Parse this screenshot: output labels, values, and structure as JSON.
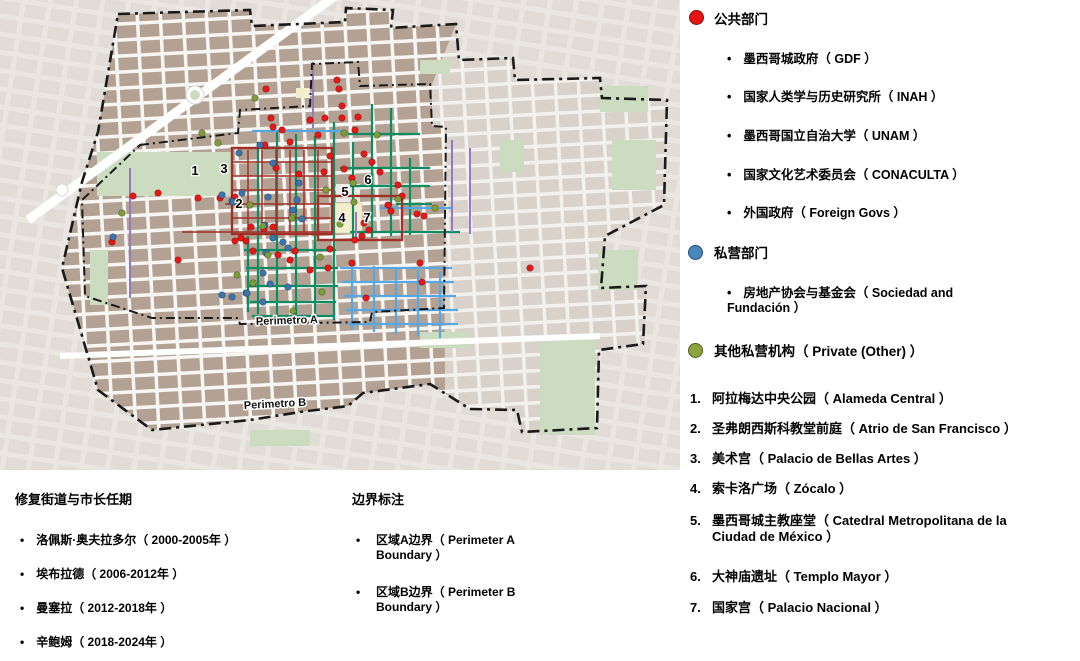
{
  "legend_public": {
    "title": "公共部门",
    "color": "#e81313",
    "items": [
      "墨西哥城政府（ GDF ）",
      "国家人类学与历史研究所（ INAH ）",
      "墨西哥国立自治大学（ UNAM ）",
      "国家文化艺术委员会（ CONACULTA ）",
      "外国政府（ Foreign Govs ）"
    ]
  },
  "legend_private": {
    "title": "私营部门",
    "color": "#4b87bd",
    "items": [
      "房地产协会与基金会（ Sociedad and Fundación ）"
    ]
  },
  "legend_other": {
    "title": "其他私营机构（ Private (Other) ）",
    "color": "#8da33d"
  },
  "landmarks": [
    {
      "num": "1.",
      "text": "阿拉梅达中央公园（ Alameda Central ）"
    },
    {
      "num": "2.",
      "text": "圣弗朗西斯科教堂前庭（ Atrio de San Francisco ）"
    },
    {
      "num": "3.",
      "text": "美术宫（ Palacio de Bellas Artes ）"
    },
    {
      "num": "4.",
      "text": "索卡洛广场（ Zócalo ）"
    },
    {
      "num": "5.",
      "text": "墨西哥城主教座堂（ Catedral Metropolitana de la Ciudad de México ）"
    },
    {
      "num": "6.",
      "text": "大神庙遗址（ Templo Mayor ）"
    },
    {
      "num": "7.",
      "text": "国家宫（ Palacio Nacional ）"
    }
  ],
  "mayors": {
    "title": "修复街道与市长任期",
    "items": [
      "洛佩斯·奥夫拉多尔（ 2000-2005年 ）",
      "埃布拉德（ 2006-2012年 ）",
      "曼塞拉（ 2012-2018年 ）",
      "辛鲍姆（ 2018-2024年 ）"
    ]
  },
  "boundaries_legend": {
    "title": "边界标注",
    "items": [
      "区域A边界（ Perimeter A Boundary ）",
      "区域B边界（ Perimeter B Boundary ）"
    ]
  },
  "map": {
    "perimeter_a_label": "Perimetro A",
    "perimeter_b_label": "Perimetro B",
    "street_colors": {
      "teal": "#0e8c62",
      "blue": "#57a7e3",
      "purple": "#9779c1",
      "red": "#a03028"
    },
    "dot_colors": {
      "red": "#ea1515",
      "blue": "#3c74ad",
      "green": "#7d9d38"
    },
    "markers": [
      {
        "n": "1",
        "x": 195,
        "y": 171
      },
      {
        "n": "2",
        "x": 239,
        "y": 204
      },
      {
        "n": "3",
        "x": 224,
        "y": 169
      },
      {
        "n": "4",
        "x": 342,
        "y": 218
      },
      {
        "n": "5",
        "x": 345,
        "y": 192
      },
      {
        "n": "6",
        "x": 368,
        "y": 180
      },
      {
        "n": "7",
        "x": 367,
        "y": 218
      }
    ],
    "dots": {
      "red": [
        [
          266,
          89
        ],
        [
          337,
          80
        ],
        [
          339,
          89
        ],
        [
          325,
          118
        ],
        [
          358,
          117
        ],
        [
          273,
          127
        ],
        [
          282,
          130
        ],
        [
          290,
          142
        ],
        [
          265,
          145
        ],
        [
          310,
          120
        ],
        [
          318,
          135
        ],
        [
          355,
          130
        ],
        [
          271,
          118
        ],
        [
          342,
          106
        ],
        [
          342,
          118
        ],
        [
          330,
          156
        ],
        [
          364,
          154
        ],
        [
          276,
          168
        ],
        [
          299,
          174
        ],
        [
          324,
          172
        ],
        [
          344,
          169
        ],
        [
          372,
          162
        ],
        [
          380,
          172
        ],
        [
          352,
          178
        ],
        [
          398,
          185
        ],
        [
          402,
          196
        ],
        [
          417,
          214
        ],
        [
          388,
          205
        ],
        [
          391,
          211
        ],
        [
          424,
          216
        ],
        [
          364,
          223
        ],
        [
          369,
          230
        ],
        [
          362,
          236
        ],
        [
          355,
          240
        ],
        [
          330,
          249
        ],
        [
          328,
          268
        ],
        [
          295,
          251
        ],
        [
          352,
          263
        ],
        [
          420,
          263
        ],
        [
          422,
          282
        ],
        [
          366,
          298
        ],
        [
          310,
          270
        ],
        [
          290,
          260
        ],
        [
          278,
          255
        ],
        [
          273,
          227
        ],
        [
          251,
          227
        ],
        [
          241,
          238
        ],
        [
          253,
          251
        ],
        [
          264,
          229
        ],
        [
          235,
          241
        ],
        [
          246,
          241
        ],
        [
          220,
          198
        ],
        [
          235,
          197
        ],
        [
          198,
          198
        ],
        [
          133,
          196
        ],
        [
          112,
          242
        ],
        [
          178,
          260
        ],
        [
          158,
          193
        ],
        [
          530,
          268
        ]
      ],
      "blue": [
        [
          260,
          145
        ],
        [
          239,
          153
        ],
        [
          273,
          163
        ],
        [
          299,
          183
        ],
        [
          232,
          201
        ],
        [
          222,
          195
        ],
        [
          242,
          193
        ],
        [
          233,
          202
        ],
        [
          268,
          197
        ],
        [
          297,
          200
        ],
        [
          293,
          210
        ],
        [
          302,
          219
        ],
        [
          265,
          225
        ],
        [
          273,
          238
        ],
        [
          283,
          242
        ],
        [
          288,
          248
        ],
        [
          266,
          253
        ],
        [
          246,
          293
        ],
        [
          263,
          273
        ],
        [
          263,
          302
        ],
        [
          270,
          284
        ],
        [
          288,
          287
        ],
        [
          222,
          295
        ],
        [
          232,
          297
        ],
        [
          247,
          293
        ],
        [
          113,
          237
        ]
      ],
      "green": [
        [
          202,
          133
        ],
        [
          344,
          133
        ],
        [
          377,
          135
        ],
        [
          353,
          183
        ],
        [
          326,
          190
        ],
        [
          354,
          202
        ],
        [
          250,
          205
        ],
        [
          340,
          224
        ],
        [
          292,
          218
        ],
        [
          263,
          226
        ],
        [
          268,
          255
        ],
        [
          320,
          257
        ],
        [
          322,
          292
        ],
        [
          293,
          311
        ],
        [
          253,
          283
        ],
        [
          255,
          98
        ],
        [
          122,
          213
        ],
        [
          237,
          275
        ],
        [
          218,
          143
        ],
        [
          398,
          199
        ],
        [
          435,
          208
        ]
      ]
    },
    "streets": {
      "teal_v": [
        [
          248,
          236,
          312
        ],
        [
          258,
          142,
          314
        ],
        [
          277,
          132,
          316
        ],
        [
          296,
          134,
          318
        ],
        [
          315,
          136,
          318
        ],
        [
          334,
          122,
          320
        ],
        [
          353,
          142,
          240
        ],
        [
          372,
          104,
          238
        ],
        [
          391,
          108,
          236
        ],
        [
          410,
          158,
          235
        ]
      ],
      "teal_h": [
        [
          134,
          348,
          420
        ],
        [
          168,
          340,
          430
        ],
        [
          186,
          350,
          430
        ],
        [
          204,
          396,
          432
        ],
        [
          232,
          350,
          460
        ],
        [
          250,
          244,
          336
        ],
        [
          268,
          246,
          338
        ],
        [
          286,
          248,
          338
        ],
        [
          302,
          250,
          336
        ],
        [
          316,
          252,
          334
        ]
      ],
      "blue_h": [
        [
          131,
          252,
          344
        ],
        [
          208,
          380,
          452
        ],
        [
          268,
          340,
          452
        ],
        [
          282,
          342,
          454
        ],
        [
          296,
          344,
          456
        ],
        [
          310,
          346,
          458
        ],
        [
          324,
          348,
          458
        ]
      ],
      "blue_v": [
        [
          352,
          264,
          330
        ],
        [
          374,
          266,
          332
        ],
        [
          396,
          268,
          334
        ],
        [
          418,
          270,
          336
        ],
        [
          440,
          272,
          338
        ]
      ],
      "purple_v": [
        [
          130,
          168,
          298
        ],
        [
          313,
          62,
          128
        ],
        [
          452,
          140,
          232
        ],
        [
          470,
          148,
          234
        ],
        [
          356,
          212,
          242
        ]
      ],
      "red_v": [
        [
          248,
          150,
          232
        ],
        [
          262,
          150,
          232
        ],
        [
          276,
          150,
          232
        ],
        [
          290,
          150,
          232
        ],
        [
          304,
          150,
          232
        ],
        [
          318,
          150,
          232
        ]
      ],
      "red_h": [
        [
          162,
          232,
          332
        ],
        [
          176,
          232,
          332
        ],
        [
          190,
          232,
          332
        ],
        [
          204,
          225,
          332
        ],
        [
          218,
          232,
          332
        ],
        [
          232,
          182,
          332
        ]
      ],
      "red_boxes": [
        [
          232,
          148,
          100,
          86
        ],
        [
          318,
          196,
          84,
          44
        ]
      ]
    }
  }
}
